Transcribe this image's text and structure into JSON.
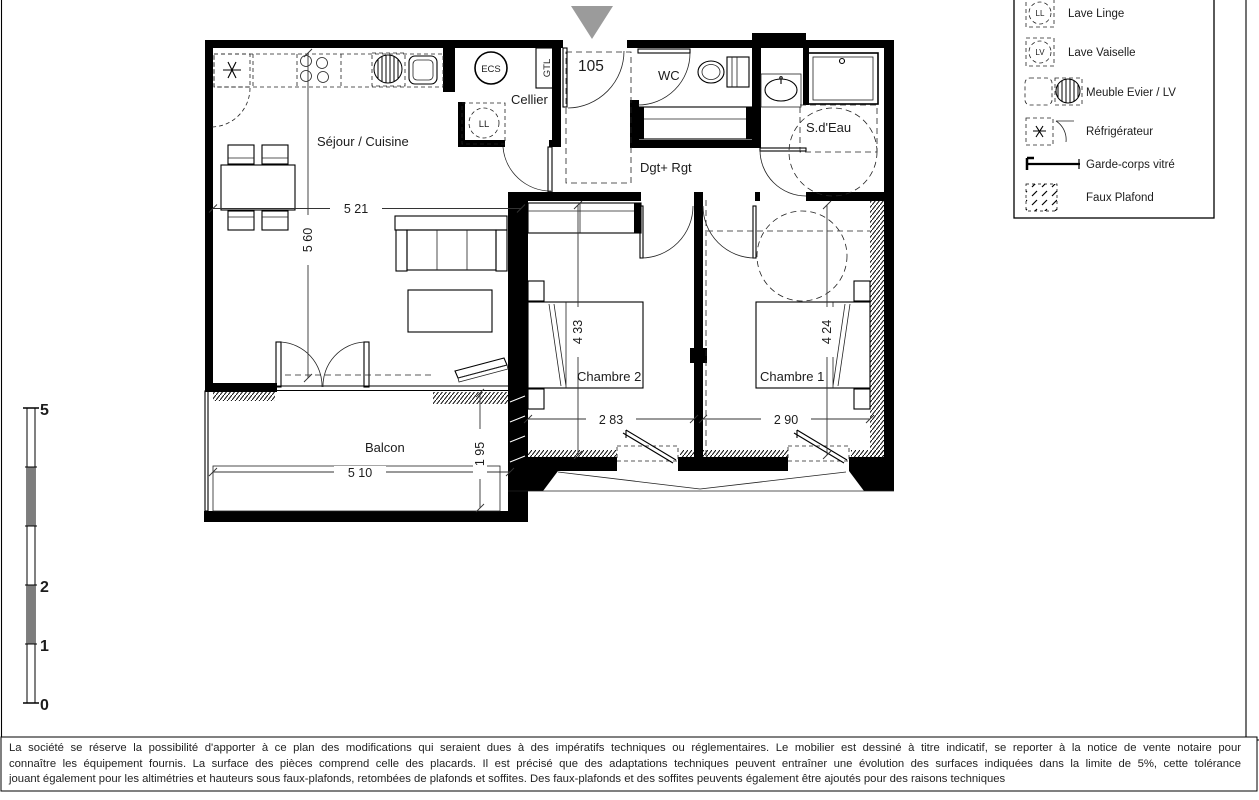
{
  "plan": {
    "entrance_number": "105",
    "rooms": {
      "sejour": "Séjour / Cuisine",
      "cellier": "Cellier",
      "wc": "WC",
      "sdeau": "S.d'Eau",
      "dgt": "Dgt+ Rgt",
      "chambre2": "Chambre 2",
      "chambre1": "Chambre 1",
      "balcon": "Balcon"
    },
    "equipment": {
      "ecs": "ECS",
      "gtl": "GTL",
      "ll": "LL"
    },
    "dimensions": {
      "sejour_w": "5 21",
      "sejour_h": "5 60",
      "ch2_h": "4 33",
      "ch2_w": "2 83",
      "ch1_h": "4 24",
      "ch1_w": "2 90",
      "balcon_w": "5 10",
      "balcon_d": "1 95"
    }
  },
  "legend": {
    "items": [
      {
        "icon": "lave-linge-icon",
        "label": "Lave Linge",
        "symbol": "LL"
      },
      {
        "icon": "lave-vaisselle-icon",
        "label": "Lave Vaiselle",
        "symbol": "LV"
      },
      {
        "icon": "meuble-evier-icon",
        "label": "Meuble Evier / LV"
      },
      {
        "icon": "refrigerateur-icon",
        "label": "Réfrigérateur"
      },
      {
        "icon": "garde-corps-icon",
        "label": "Garde-corps vitré"
      },
      {
        "icon": "faux-plafond-icon",
        "label": "Faux Plafond"
      }
    ]
  },
  "scale_bar": {
    "top": "5",
    "mid": "2",
    "low": "1",
    "bottom": "0"
  },
  "page": {
    "disclaimer_lines": [
      "La société se réserve la possibilité d'apporter à ce plan des modifications qui seraient dues à des impératifs techniques ou réglementaires. Le mobilier est dessiné à titre indicatif, se reporter à la notice de vente notaire pour",
      "connaître les équipement fournis. La surface des pièces comprend celle des placards. Il est précisé que des adaptations techniques peuvent entraîner une évolution des surfaces indiquées dans la limite de 5%, cette tolérance",
      "jouant également pour les altimétries et hauteurs sous faux-plafonds, retombées de plafonds et soffites. Des faux-plafonds et des soffites peuvents également être ajoutés pour des raisons techniques"
    ]
  },
  "colors": {
    "wall": "#000000",
    "entrance_arrow": "#9b9b9b",
    "scale_gray": "#7d7d7d"
  }
}
